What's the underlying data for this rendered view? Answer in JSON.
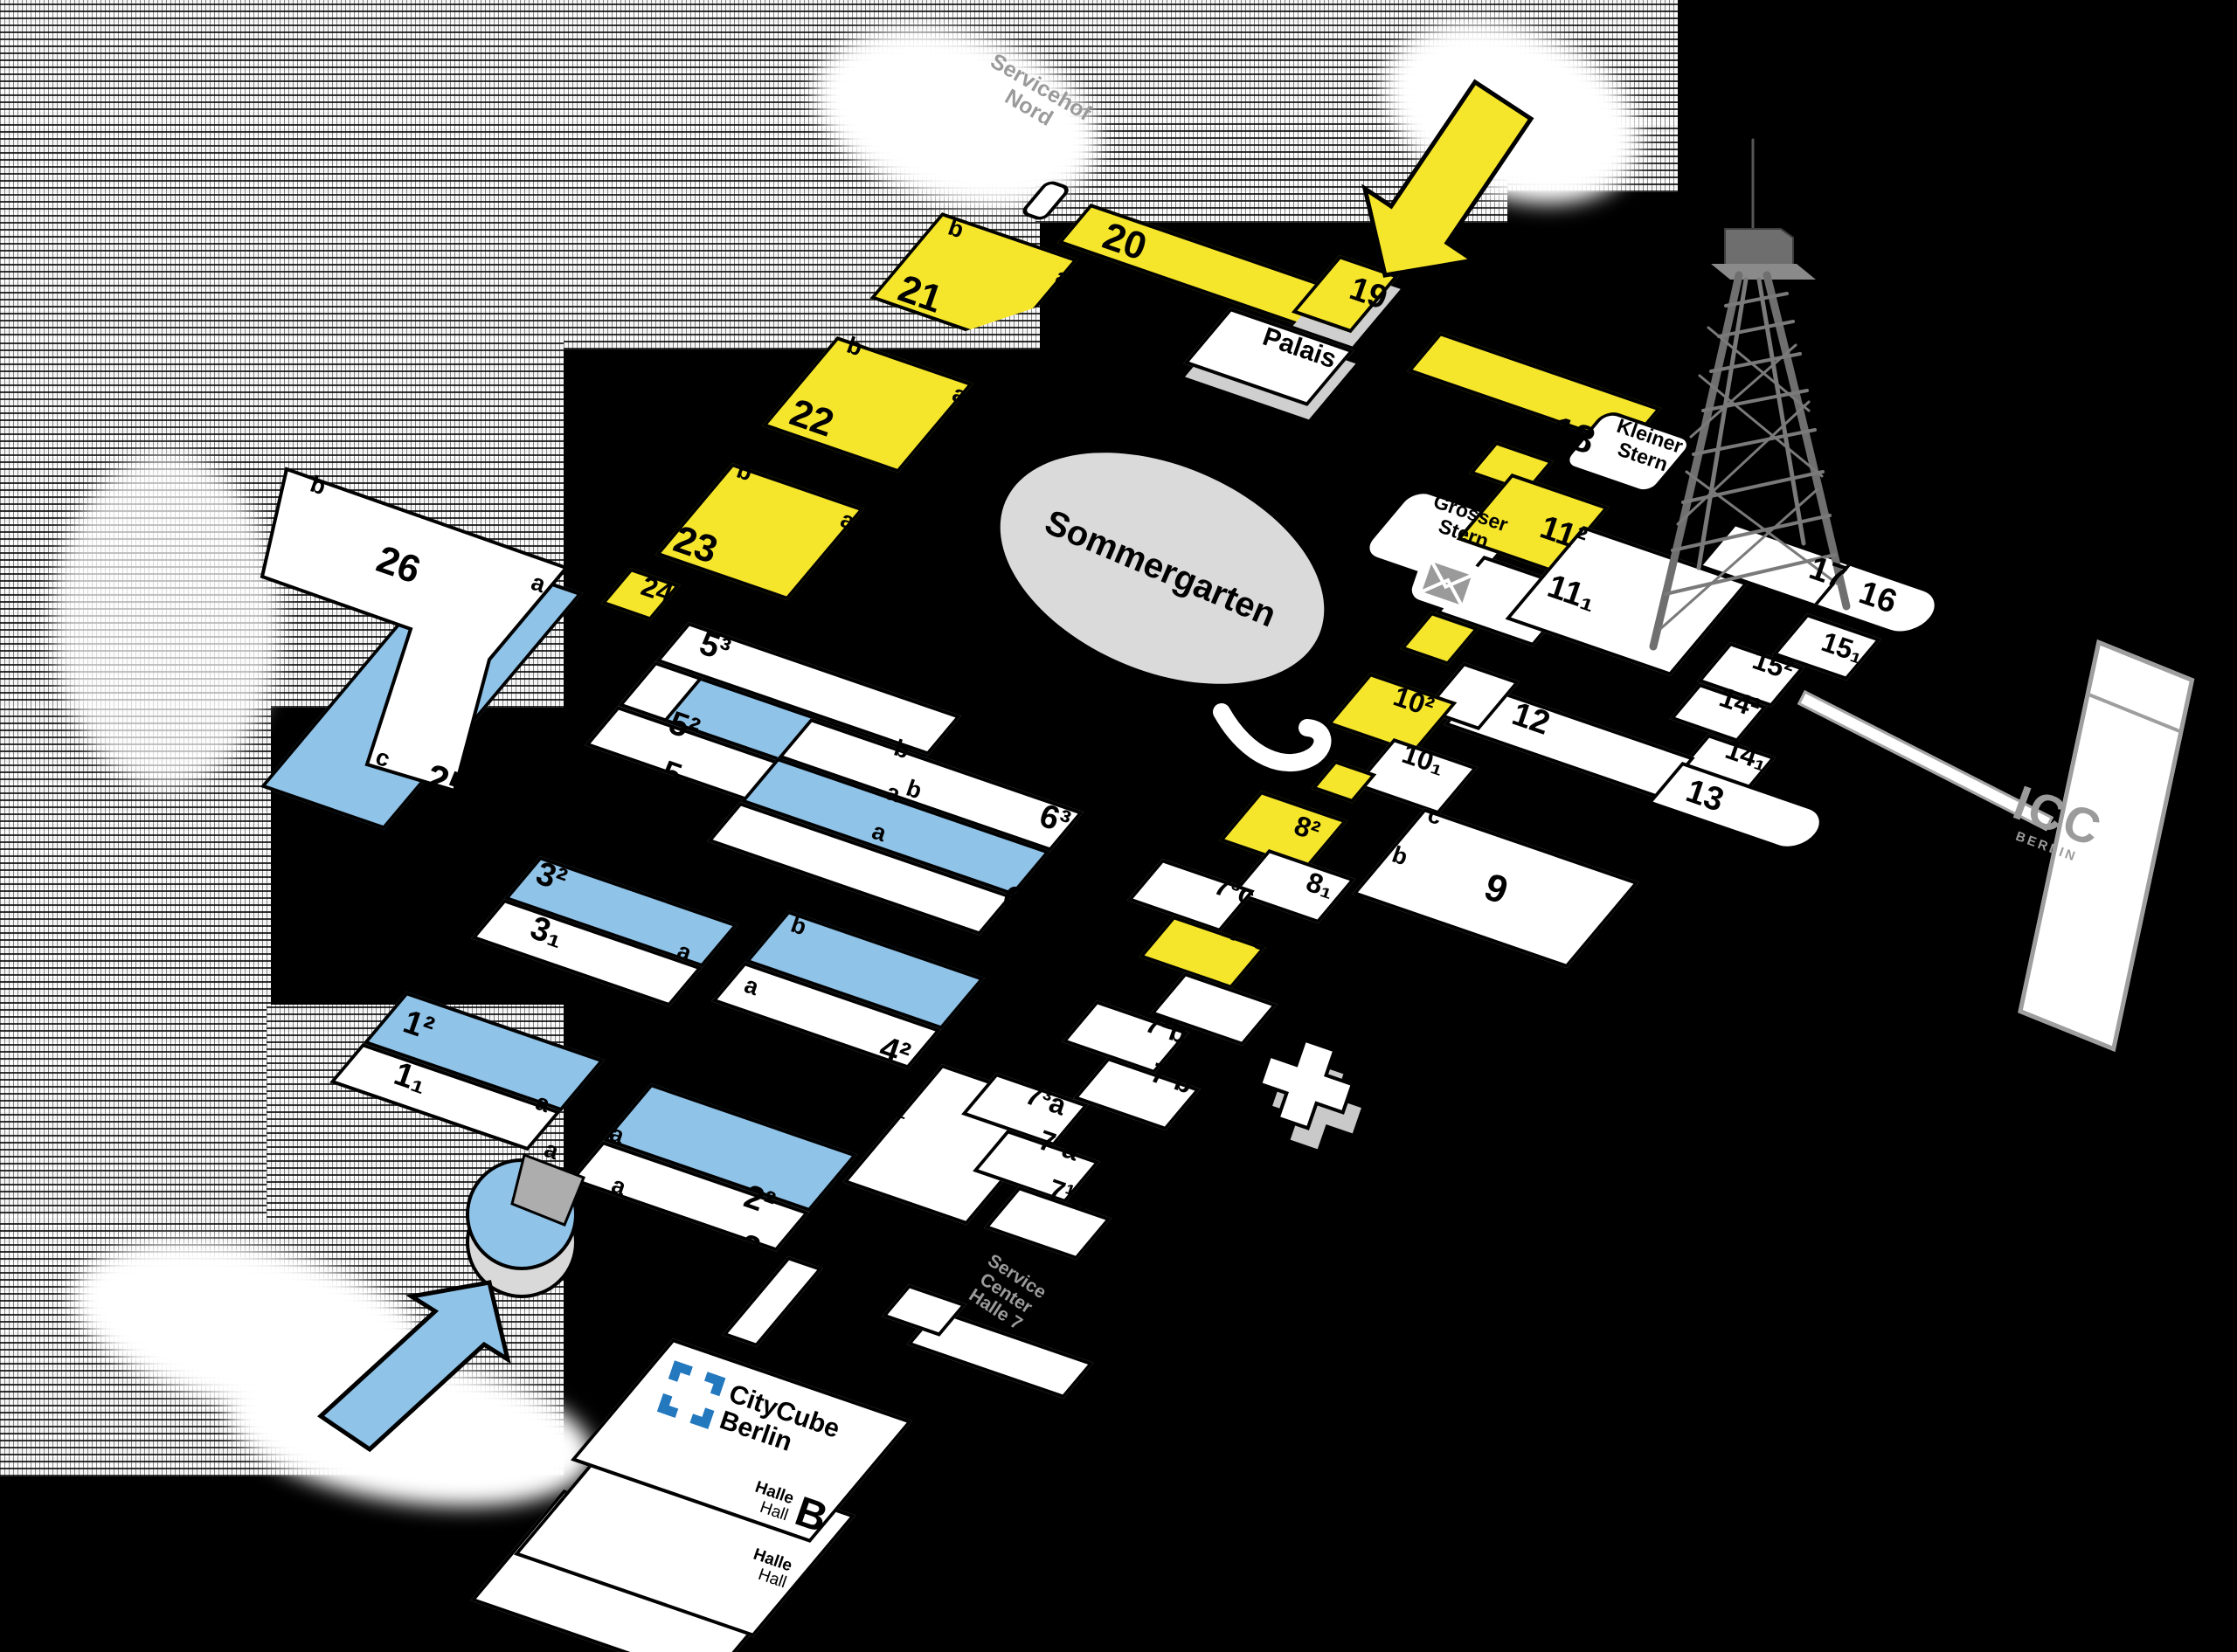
{
  "halls": {
    "h20": "20",
    "h21": "21",
    "h22": "22",
    "h23": "23",
    "h24": "24",
    "h25": "25",
    "h26": "26",
    "h19": "19",
    "h18": "18",
    "h17": "17",
    "h16": "16",
    "h15_1": "15₁",
    "h15_2": "15²",
    "h14_1": "14₁",
    "h14_2": "14²",
    "h13": "13",
    "h12": "12",
    "h11_1": "11₁",
    "h11_2": "11²",
    "h10_1": "10₁",
    "h10_2": "10²",
    "h9": "9",
    "h8_1": "8₁",
    "h8_2": "8²",
    "h7_3c": "7³c",
    "h7_2c": "7²c",
    "h7_1c": "7¹c",
    "h7_2b": "7²b",
    "h7_1b": "7¹b",
    "h7_3a": "7³a",
    "h7_2a": "7²a",
    "h7_1a": "7¹a",
    "h6_3": "6³",
    "h6_2": "6²",
    "h6_1": "6₁",
    "h5_3": "5³",
    "h5_2": "5²",
    "h5_1": "5₁",
    "h4_2": "4²",
    "h4_1": "4₁",
    "h3_2": "3²",
    "h3_1": "3₁",
    "h2_2": "2²",
    "h2_1": "2₁",
    "h1_2": "1²",
    "h1_1": "1₁"
  },
  "letters": {
    "a": "a",
    "b": "b",
    "c": "c"
  },
  "places": {
    "palais": "Palais",
    "sommergarten": "Sommergarten",
    "marshall": "Marshall-Haus",
    "kleiner_stern": [
      "Kleiner",
      "Stern"
    ],
    "grosser_stern": [
      "Grosser",
      "Stern"
    ],
    "servicehof": [
      "Servicehof",
      "Nord"
    ],
    "service_center": [
      "Service",
      "Center",
      "Halle 7"
    ],
    "icc": [
      "ICC",
      "BERLIN"
    ],
    "citycube": [
      "CityCube",
      "Berlin"
    ],
    "halle": "Halle",
    "hall": "Hall",
    "hall_a": "A",
    "hall_b": "B"
  },
  "colors": {
    "yellow": "#F6E62B",
    "blue": "#8FC3E8",
    "brand_blue": "#2478BE",
    "muted_gray": "#9A9A9A"
  }
}
